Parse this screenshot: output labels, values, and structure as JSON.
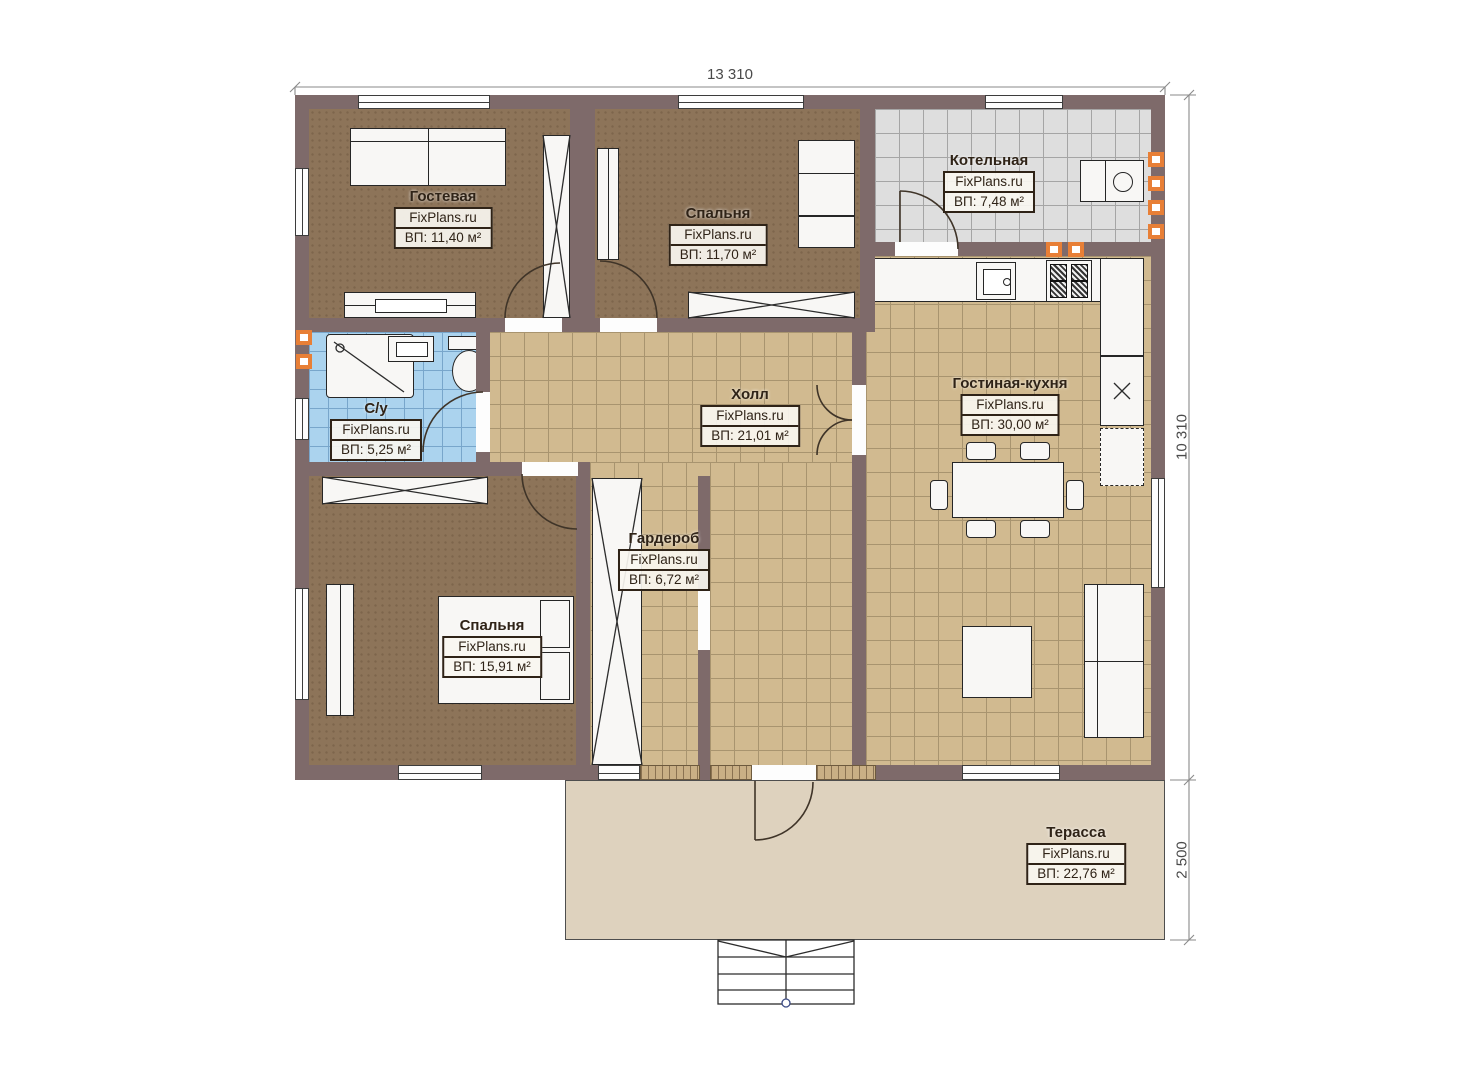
{
  "site": "FixPlans.ru",
  "dimensions": {
    "top": "13 310",
    "right": "10 310",
    "terrace": "2 500"
  },
  "rooms": [
    {
      "name": "Гостевая",
      "brand": "FixPlans.ru",
      "area": "ВП: 11,40 м²"
    },
    {
      "name": "Спальня",
      "brand": "FixPlans.ru",
      "area": "ВП: 11,70 м²"
    },
    {
      "name": "Котельная",
      "brand": "FixPlans.ru",
      "area": "ВП: 7,48 м²"
    },
    {
      "name": "С/у",
      "brand": "FixPlans.ru",
      "area": "ВП: 5,25 м²"
    },
    {
      "name": "Холл",
      "brand": "FixPlans.ru",
      "area": "ВП: 21,01 м²"
    },
    {
      "name": "Гостиная-кухня",
      "brand": "FixPlans.ru",
      "area": "ВП: 30,00 м²"
    },
    {
      "name": "Гардероб",
      "brand": "FixPlans.ru",
      "area": "ВП: 6,72 м²"
    },
    {
      "name": "Спальня",
      "brand": "FixPlans.ru",
      "area": "ВП: 15,91 м²"
    },
    {
      "name": "Терасса",
      "brand": "FixPlans.ru",
      "area": "ВП: 22,76 м²"
    }
  ],
  "colors": {
    "wall": "#7e6a6a",
    "floor_bedroom": "#8d7459",
    "tile_hall": "#d1ba90",
    "tile_boiler": "#dedede",
    "tile_bathroom": "#abd3ee",
    "terrace": "#ded2be",
    "vent_accent": "#e87f36"
  }
}
